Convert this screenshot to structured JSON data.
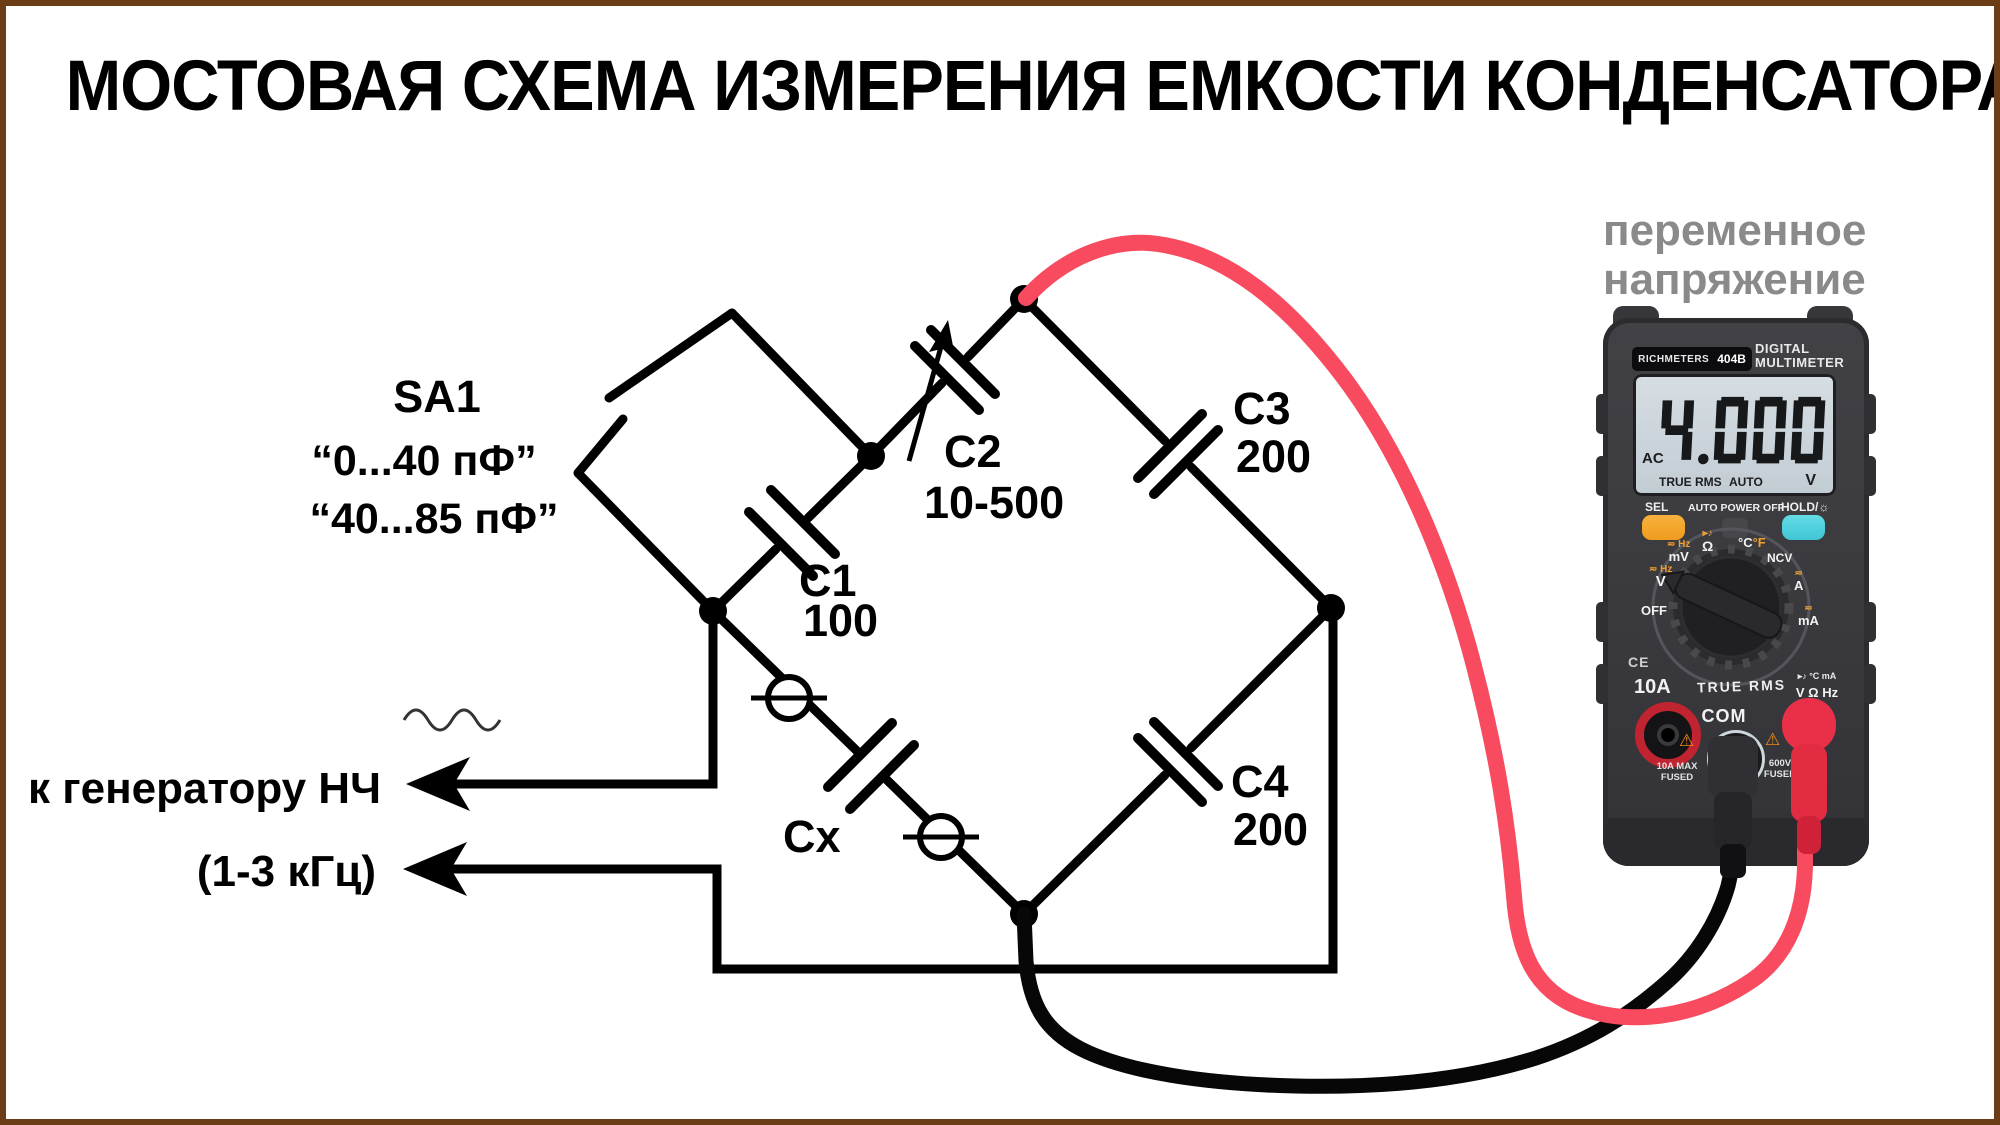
{
  "title": "МОСТОВАЯ СХЕМА ИЗМЕРЕНИЯ ЕМКОСТИ КОНДЕНСАТОРА",
  "colors": {
    "border": "#6b3d16",
    "red_wire": "#f84b60",
    "black_wire": "#070707",
    "note_gray": "#8a8a8a",
    "orange_btn": "#f0a02c",
    "cyan_btn": "#4fd0de"
  },
  "schematic": {
    "switch": "SA1",
    "range1": "“0...40 пФ”",
    "range2": "“40...85 пФ”",
    "c1": "C1",
    "c1_value": "100",
    "c2": "C2",
    "c2_value": "10-500",
    "c3": "C3",
    "c3_value": "200",
    "c4": "C4",
    "c4_value": "200",
    "cx": "Cx",
    "generator_line1": "к генератору НЧ",
    "generator_line2": "(1-3 кГц)"
  },
  "multimeter": {
    "note_line1": "переменное",
    "note_line2": "напряжение",
    "brand": "RICHMETERS",
    "model": "404B",
    "type_line1": "DIGITAL",
    "type_line2": "MULTIMETER",
    "display": {
      "mode": "AC",
      "value": "4.000",
      "true_rms": "TRUE RMS",
      "auto": "AUTO",
      "unit": "V"
    },
    "buttons": {
      "sel": "SEL",
      "auto_power_off": "AUTO POWER OFF",
      "hold": "HOLD/☼"
    },
    "dial": {
      "off": "OFF",
      "v_sym": "≂ Hz",
      "v": "V",
      "mv_sym": "≂ Hz",
      "mv": "mV",
      "ohm_sym": "▸♪",
      "ohm": "Ω",
      "temp_c": "°C",
      "temp_f": "°F",
      "ncv": "NCV",
      "a_sym": "≂",
      "a": "A",
      "ma_sym": "≂",
      "ma": "mA",
      "true_rms": "TRUE RMS"
    },
    "jacks": {
      "ce": "CE",
      "left": "10A",
      "left_sub1": "10A MAX",
      "left_sub2": "FUSED",
      "com": "COM",
      "right_icons": "▸♪ °C mA",
      "right": "V Ω Hz",
      "right_sub1": "600V",
      "right_sub2": "FUSED"
    }
  }
}
